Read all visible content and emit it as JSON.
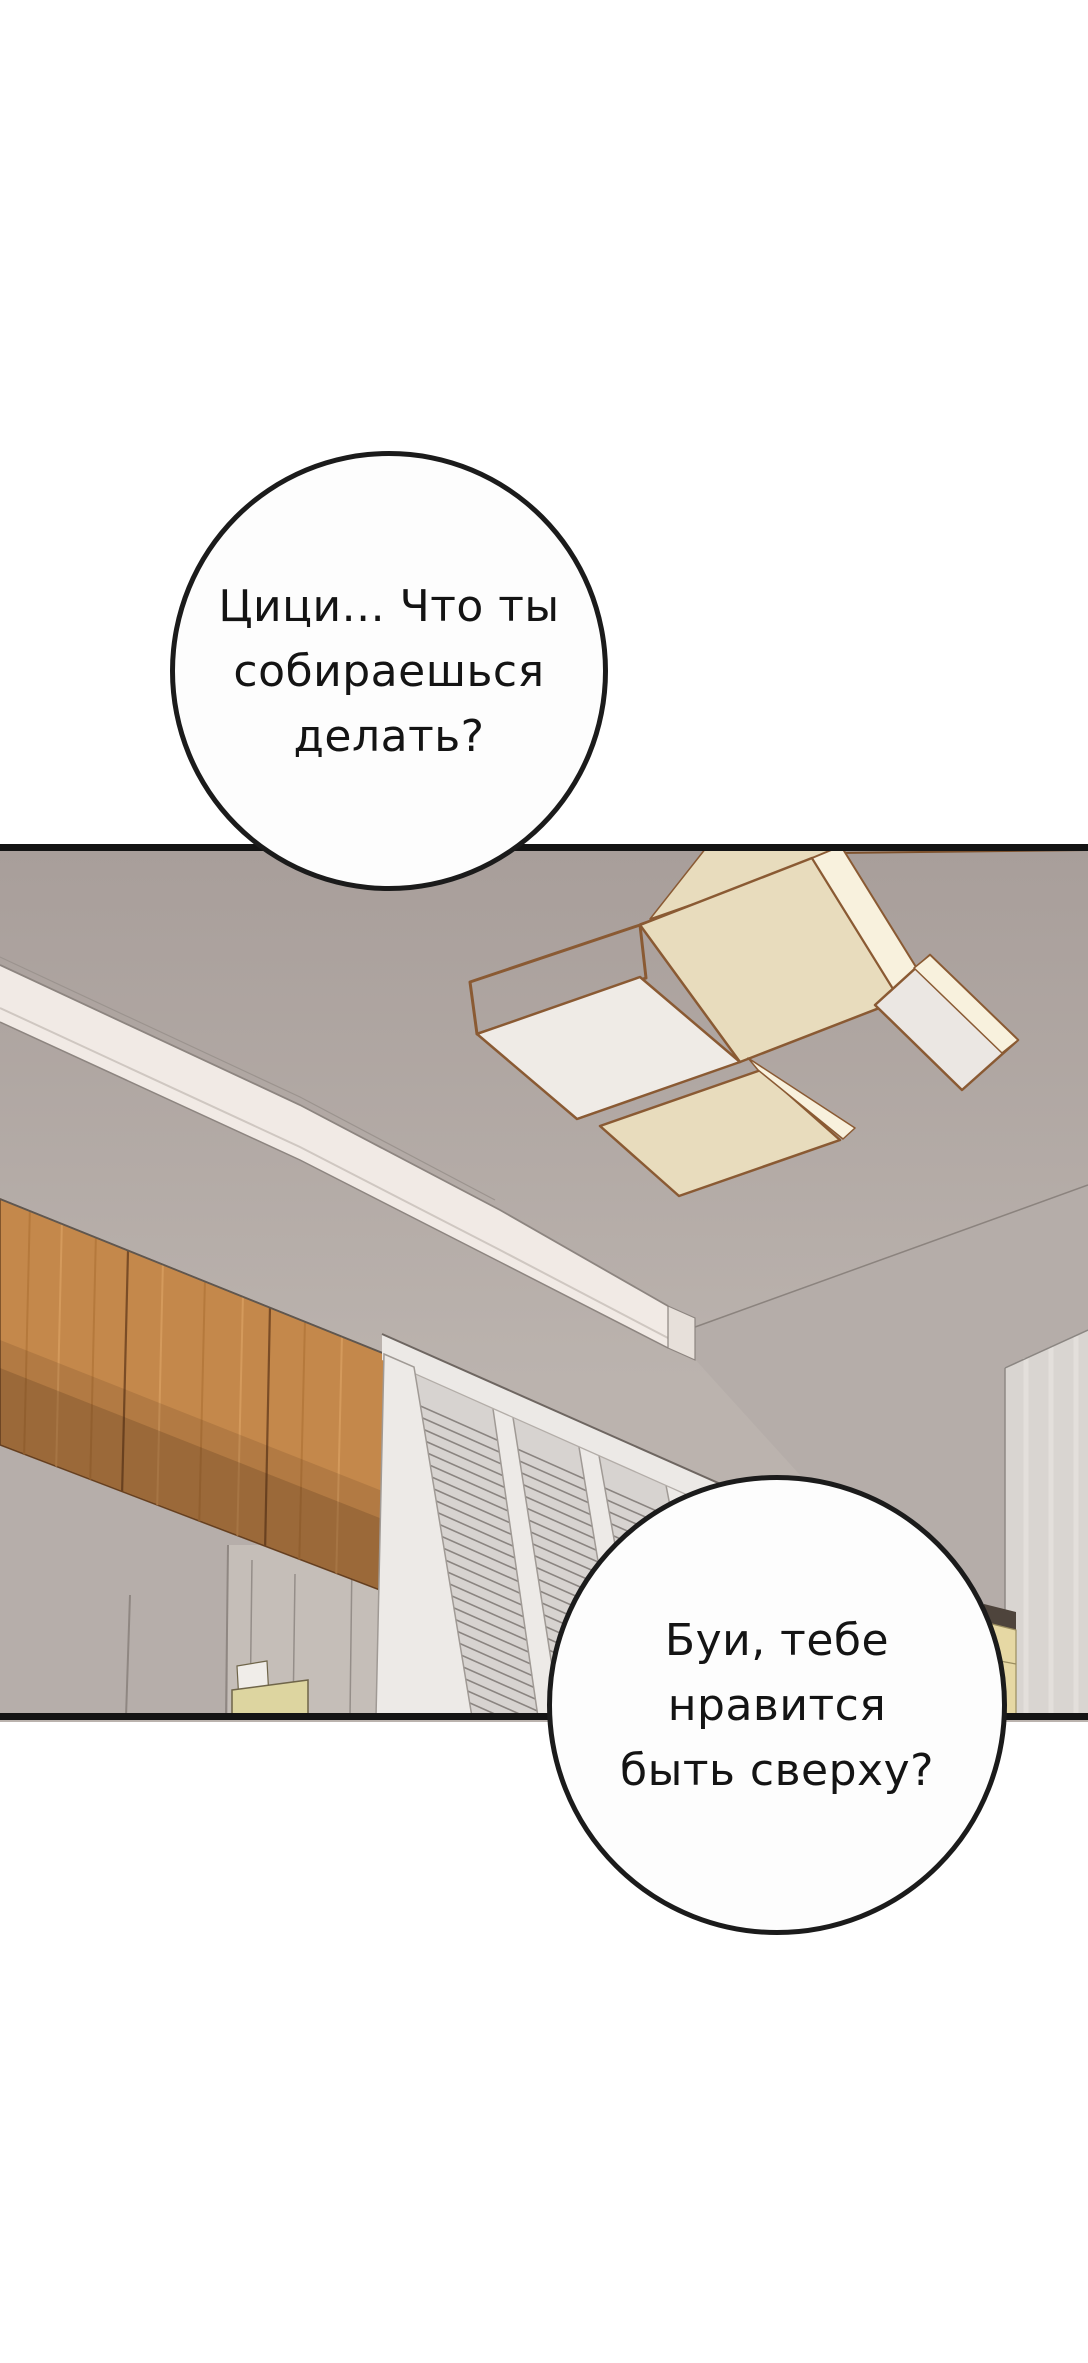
{
  "bubbles": [
    {
      "id": "top",
      "lines": [
        "Цици... Что ты",
        "собираешься",
        "делать?"
      ]
    },
    {
      "id": "bottom",
      "lines": [
        "Буи, тебе",
        "нравится",
        "быть сверху?"
      ]
    }
  ],
  "colors": {
    "page_bg": "#ffffff",
    "bubble_fill": "#fdfdfd",
    "bubble_outline": "#1b1b1b",
    "panel_border": "#141414",
    "ceiling_top": "#a89e9a",
    "ceiling_bottom": "#bbb3ae",
    "beam_white": "#f1eae5",
    "beam_shade": "#ddd5cf",
    "fixture_frame": "#8a5a33",
    "fixture_cream": "#e8dcbd",
    "fixture_white": "#efebe6",
    "fixture_glow": "#f8f1dd",
    "wood_cabinet": "#c4884b",
    "wood_seam": "#7a4c26",
    "louver_fill": "#d7d3d0",
    "stile_white": "#edeae7",
    "wall_gray": "#b5ada9",
    "right_panel": "#d9d5d1",
    "dark_strip": "#4e443c",
    "cabinet_yellow": "#e6d8a4",
    "bed_yellow": "#ddd5a0",
    "nook_fill": "#c5beb8"
  }
}
